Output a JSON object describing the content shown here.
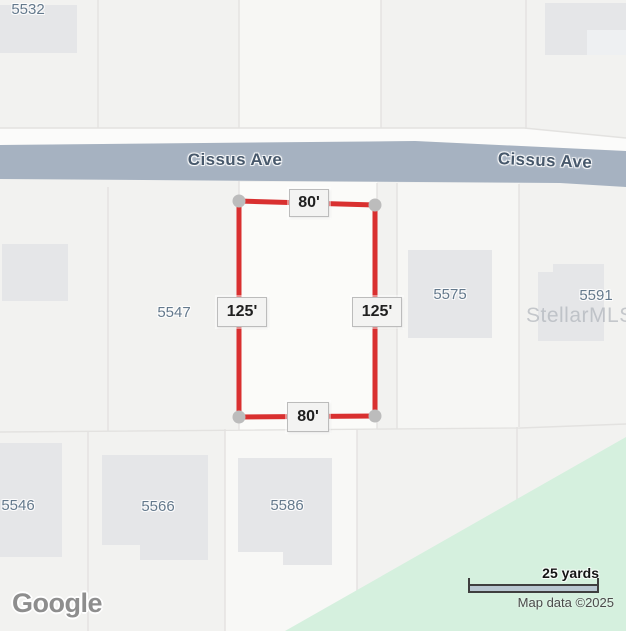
{
  "street": {
    "left_label": "Cissus Ave",
    "right_label": "Cissus Ave"
  },
  "lots": {
    "n5532": "5532",
    "n5547": "5547",
    "n5575": "5575",
    "n5591": "5591",
    "n5546": "5546",
    "n5566": "5566",
    "n5586": "5586"
  },
  "survey": {
    "top": "80'",
    "bottom": "80'",
    "left": "125'",
    "right": "125'"
  },
  "watermark": "StellarMLS",
  "footer": {
    "logo": "Google",
    "scale_label": "25 yards",
    "attribution": "Map data ©2025"
  },
  "colors": {
    "road": "#a6b2c1",
    "survey-red": "#d93030",
    "park-green": "#d5f0de",
    "building": "#e5e6e8",
    "lot-text": "#64798c",
    "street-text": "#47586b"
  }
}
